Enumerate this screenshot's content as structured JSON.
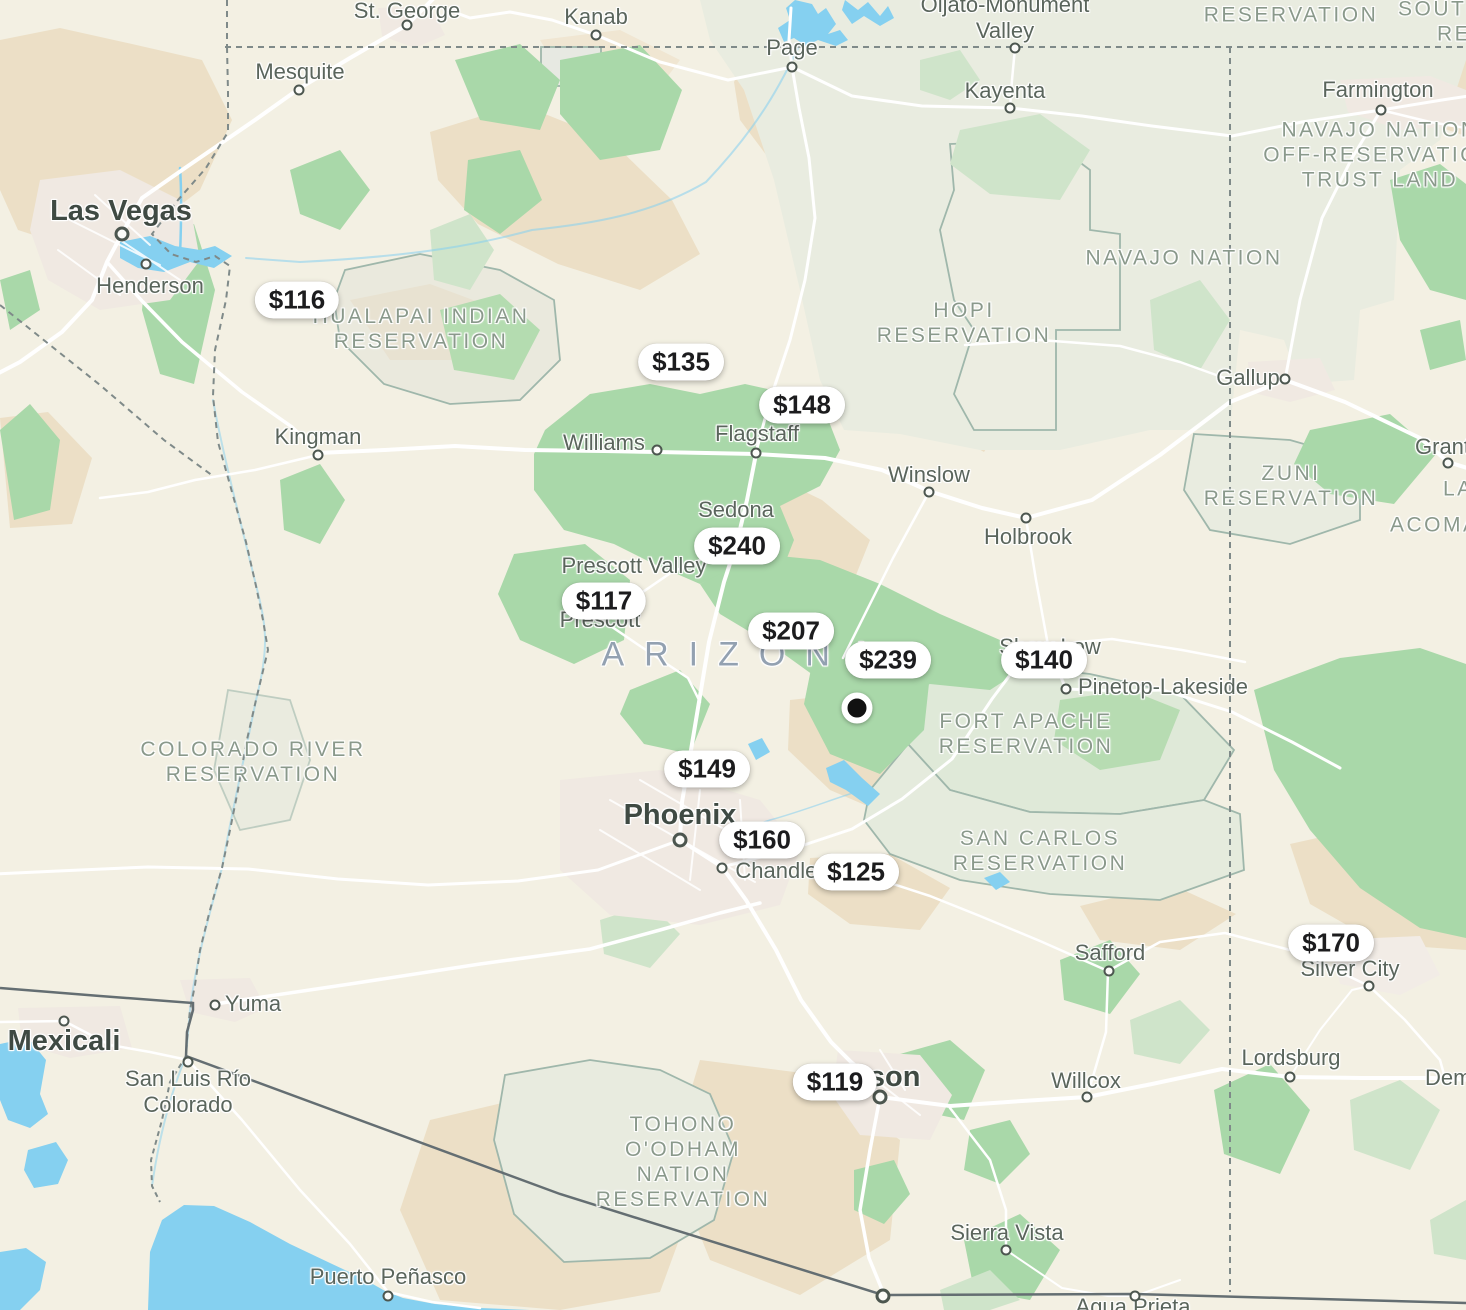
{
  "app": {
    "name": "map-listings-view"
  },
  "colors": {
    "land": "#f3f0e3",
    "land_muted": "#e9ece0",
    "desert_tan": "#ecdfc6",
    "desert_tan_light": "#f0e6d2",
    "forest_green": "#a9d8a9",
    "forest_green_pale": "#cfe4ca",
    "water_blue": "#85d0f0",
    "road_white": "#ffffff",
    "reservation_line": "#9fb7ab",
    "border_gray": "#7f8a89",
    "border_solid": "#646e72",
    "city_text": "#5a655c",
    "city_text_large": "#3f4a43",
    "area_text": "#8a998b",
    "state_text": "#93a1b1",
    "pin_bg": "#ffffff",
    "pin_text": "#1c1c1e",
    "selected_pin": "#111111"
  },
  "price_pins": [
    {
      "label": "$116",
      "x": 297,
      "y": 300
    },
    {
      "label": "$135",
      "x": 681,
      "y": 362
    },
    {
      "label": "$148",
      "x": 802,
      "y": 405
    },
    {
      "label": "$240",
      "x": 737,
      "y": 546
    },
    {
      "label": "$117",
      "x": 604,
      "y": 601
    },
    {
      "label": "$207",
      "x": 791,
      "y": 631
    },
    {
      "label": "$239",
      "x": 888,
      "y": 660
    },
    {
      "label": "$140",
      "x": 1044,
      "y": 660
    },
    {
      "label": "$149",
      "x": 707,
      "y": 769
    },
    {
      "label": "$160",
      "x": 762,
      "y": 840
    },
    {
      "label": "$125",
      "x": 856,
      "y": 872
    },
    {
      "label": "$170",
      "x": 1331,
      "y": 943
    },
    {
      "label": "$119",
      "x": 835,
      "y": 1082
    }
  ],
  "selected_pin": {
    "x": 857,
    "y": 708
  },
  "state_labels": [
    {
      "text": "ARIZONA",
      "x": 747,
      "y": 655
    }
  ],
  "area_labels": [
    {
      "lines": [
        "RESERVATION"
      ],
      "x": 1291,
      "y": 15
    },
    {
      "lines": [
        "SOUTH"
      ],
      "x": 1398,
      "y": 9,
      "align": "left"
    },
    {
      "lines": [
        "RESE"
      ],
      "x": 1437,
      "y": 34,
      "align": "left"
    },
    {
      "lines": [
        "NAVAJO NATION",
        "OFF-RESERVATION",
        "TRUST LAND"
      ],
      "x": 1380,
      "y": 155
    },
    {
      "lines": [
        "NAVAJO NATION"
      ],
      "x": 1184,
      "y": 258
    },
    {
      "lines": [
        "HOPI",
        "RESERVATION"
      ],
      "x": 964,
      "y": 323
    },
    {
      "lines": [
        "HUALAPAI INDIAN",
        "RESERVATION"
      ],
      "x": 421,
      "y": 329
    },
    {
      "lines": [
        "ZUNI",
        "RESERVATION"
      ],
      "x": 1291,
      "y": 486
    },
    {
      "lines": [
        "LA"
      ],
      "x": 1443,
      "y": 489,
      "align": "left"
    },
    {
      "lines": [
        "ACOMA"
      ],
      "x": 1390,
      "y": 525,
      "align": "left"
    },
    {
      "lines": [
        "COLORADO RIVER",
        "RESERVATION"
      ],
      "x": 253,
      "y": 762
    },
    {
      "lines": [
        "FORT APACHE",
        "RESERVATION"
      ],
      "x": 1026,
      "y": 734
    },
    {
      "lines": [
        "SAN CARLOS",
        "RESERVATION"
      ],
      "x": 1040,
      "y": 851
    },
    {
      "lines": [
        "TOHONO",
        "O'ODHAM",
        "NATION",
        "RESERVATION"
      ],
      "x": 683,
      "y": 1162
    }
  ],
  "city_labels": [
    {
      "name": "St. George",
      "x": 407,
      "y": 11,
      "marker": {
        "x": 407,
        "y": 25
      }
    },
    {
      "name": "Kanab",
      "x": 596,
      "y": 17,
      "marker": {
        "x": 596,
        "y": 35
      }
    },
    {
      "name": "Mesquite",
      "x": 300,
      "y": 72,
      "marker": {
        "x": 299,
        "y": 90
      }
    },
    {
      "name": "Page",
      "x": 792,
      "y": 48,
      "marker": {
        "x": 792,
        "y": 67
      }
    },
    {
      "name": "Oljato-Monument Valley",
      "lines": [
        "Oljato-Monument",
        "Valley"
      ],
      "x": 1005,
      "y": 18,
      "marker": {
        "x": 1015,
        "y": 48
      }
    },
    {
      "name": "Kayenta",
      "x": 1005,
      "y": 91,
      "marker": {
        "x": 1010,
        "y": 108
      }
    },
    {
      "name": "Farmington",
      "x": 1378,
      "y": 90,
      "marker": {
        "x": 1381,
        "y": 110
      }
    },
    {
      "name": "Las Vegas",
      "tier": "large",
      "x": 121,
      "y": 211,
      "marker": {
        "x": 122,
        "y": 234,
        "size": "large"
      }
    },
    {
      "name": "Henderson",
      "x": 150,
      "y": 286,
      "marker": {
        "x": 146,
        "y": 264
      }
    },
    {
      "name": "Kingman",
      "x": 318,
      "y": 437,
      "marker": {
        "x": 318,
        "y": 455
      }
    },
    {
      "name": "Williams",
      "x": 604,
      "y": 443,
      "marker": {
        "x": 657,
        "y": 450
      }
    },
    {
      "name": "Flagstaff",
      "x": 757,
      "y": 434,
      "marker": {
        "x": 756,
        "y": 453
      }
    },
    {
      "name": "Winslow",
      "x": 929,
      "y": 475,
      "marker": {
        "x": 929,
        "y": 492
      }
    },
    {
      "name": "Holbrook",
      "x": 1028,
      "y": 537,
      "marker": {
        "x": 1026,
        "y": 518
      }
    },
    {
      "name": "Sedona",
      "x": 736,
      "y": 510
    },
    {
      "name": "Prescott Valley",
      "x": 634,
      "y": 566
    },
    {
      "name": "Prescott",
      "x": 600,
      "y": 620
    },
    {
      "name": "Gallup",
      "x": 1248,
      "y": 378,
      "marker": {
        "x": 1285,
        "y": 379
      }
    },
    {
      "name": "Grants",
      "x": 1415,
      "y": 447,
      "align": "left",
      "marker": {
        "x": 1448,
        "y": 463
      }
    },
    {
      "name": "Show Low",
      "x": 1050,
      "y": 647
    },
    {
      "name": "Pinetop-Lakeside",
      "x": 1163,
      "y": 687,
      "marker": {
        "x": 1066,
        "y": 689
      }
    },
    {
      "name": "Phoenix",
      "tier": "large",
      "x": 680,
      "y": 815,
      "marker": {
        "x": 680,
        "y": 840,
        "size": "large"
      }
    },
    {
      "name": "Chandler",
      "x": 780,
      "y": 871,
      "marker": {
        "x": 722,
        "y": 868
      }
    },
    {
      "name": "Safford",
      "x": 1110,
      "y": 953,
      "marker": {
        "x": 1109,
        "y": 971
      }
    },
    {
      "name": "Silver City",
      "x": 1350,
      "y": 969,
      "marker": {
        "x": 1369,
        "y": 986
      }
    },
    {
      "name": "Willcox",
      "x": 1086,
      "y": 1081,
      "marker": {
        "x": 1087,
        "y": 1097
      }
    },
    {
      "name": "Lordsburg",
      "x": 1291,
      "y": 1058,
      "marker": {
        "x": 1290,
        "y": 1077
      }
    },
    {
      "name": "Deming",
      "x": 1425,
      "y": 1078,
      "align": "left"
    },
    {
      "name": "Tucson",
      "tier": "large",
      "x": 870,
      "y": 1077,
      "marker": {
        "x": 880,
        "y": 1097,
        "size": "large"
      }
    },
    {
      "name": "Yuma",
      "x": 253,
      "y": 1004,
      "marker": {
        "x": 215,
        "y": 1005
      }
    },
    {
      "name": "Mexicali",
      "tier": "large",
      "x": 64,
      "y": 1041,
      "marker": {
        "x": 64,
        "y": 1021
      }
    },
    {
      "name": "San Luis Río Colorado",
      "lines": [
        "San Luis Río",
        "Colorado"
      ],
      "x": 188,
      "y": 1092,
      "marker": {
        "x": 188,
        "y": 1062
      }
    },
    {
      "name": "Puerto Peñasco",
      "x": 388,
      "y": 1277,
      "marker": {
        "x": 388,
        "y": 1296
      }
    },
    {
      "name": "Sierra Vista",
      "x": 1007,
      "y": 1233,
      "marker": {
        "x": 1006,
        "y": 1250
      }
    },
    {
      "name": "Agua Prieta",
      "x": 1133,
      "y": 1307,
      "marker": {
        "x": 1135,
        "y": 1296
      }
    }
  ],
  "extra_markers": [
    {
      "x": 883,
      "y": 1296,
      "size": "large"
    }
  ]
}
